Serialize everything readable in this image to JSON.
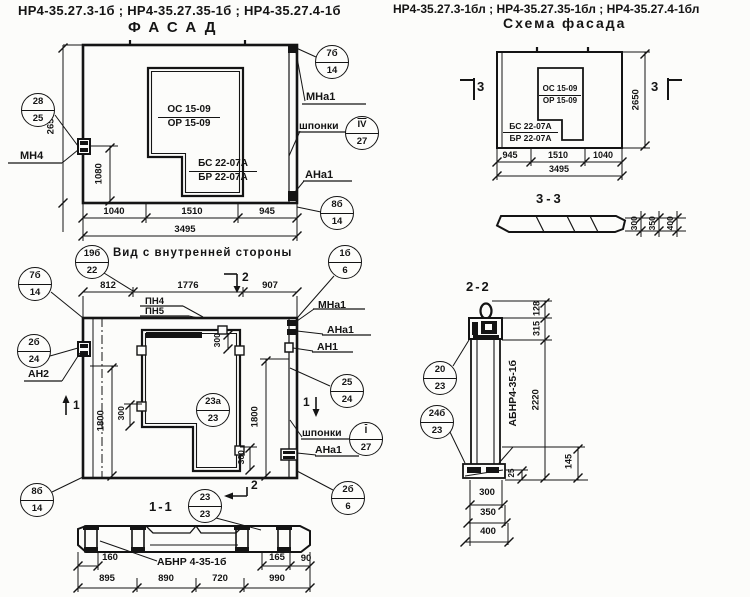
{
  "colors": {
    "ink": "#141414",
    "paper": "#fcfcfa"
  },
  "header": {
    "codes_left": "НР4-35.27.3-1б ;  НР4-35.27.35-1б ;  НР4-35.27.4-1б",
    "codes_right": "НР4-35.27.3-1бл ;  НР4-35.27.35-1бл ;  НР4-35.27.4-1бл"
  },
  "facade": {
    "title": "ФАСАД",
    "opening_mark_top": "ОС 15-09",
    "opening_mark_bottom": "ОР 15-09",
    "sill_mark_top": "БС 22-07А",
    "sill_mark_bottom": "БР 22-07А",
    "dim_height": "2650",
    "dim_inner": "1080",
    "dims_bottom": [
      "1040",
      "1510",
      "945"
    ],
    "dim_total": "3495",
    "label_mn4": "МН4",
    "label_mna1": "МНа1",
    "label_shponki": "шпонки",
    "label_ana1": "АНа1",
    "circle_top_right": {
      "top": "7б",
      "bottom": "14"
    },
    "circle_left": {
      "top": "28",
      "bottom": "25"
    },
    "circle_shponki": {
      "top": "IV",
      "bottom": "27"
    },
    "circle_bottom_right": {
      "top": "8б",
      "bottom": "14"
    }
  },
  "scheme": {
    "title": "Схема фасада",
    "opening_mark_top": "ОС 15-09",
    "opening_mark_bottom": "ОР 15-09",
    "sill_mark_top": "БС 22-07А",
    "sill_mark_bottom": "БР 22-07А",
    "dim_height": "2650",
    "dims_bottom": [
      "945",
      "1510",
      "1040"
    ],
    "dim_total": "3495",
    "section_mark": "3",
    "section_view": {
      "title": "3-3",
      "dims": [
        "300",
        "350",
        "400"
      ]
    }
  },
  "inner_view": {
    "title": "Вид с внутренней стороны",
    "dims_top": [
      "812",
      "1776",
      "907"
    ],
    "label_pn4": "ПН4",
    "label_pn5": "ПН5",
    "dim_left": "1800",
    "dim_right": "1800",
    "dim_300_top": "300",
    "dim_300_left": "300",
    "dim_300_bottom": "300",
    "label_mna1": "МНа1",
    "label_ana1_top": "АНа1",
    "label_an1": "АН1",
    "label_an2": "АН2",
    "label_shponki": "шпонки",
    "label_ana1_bottom": "АНа1",
    "mark_section1": "1",
    "mark_section2": "2",
    "circle_top_left": {
      "top": "19б",
      "bottom": "22"
    },
    "circle_top_right": {
      "top": "1б",
      "bottom": "6"
    },
    "circle_left_upper": {
      "top": "7б",
      "bottom": "14"
    },
    "circle_an2": {
      "top": "2б",
      "bottom": "24"
    },
    "circle_left_lower": {
      "top": "8б",
      "bottom": "14"
    },
    "circle_right_upper": {
      "top": "25",
      "bottom": "24"
    },
    "circle_shponki": {
      "top": "I",
      "bottom": "27"
    },
    "circle_right_lower": {
      "top": "2б",
      "bottom": "6"
    },
    "circle_center": {
      "top": "23а",
      "bottom": "23"
    }
  },
  "section_1_1": {
    "title": "1-1",
    "circle": {
      "top": "23",
      "bottom": "23"
    },
    "panel_mark": "АБНР 4-35-1б",
    "dim_160": "160",
    "dim_165": "165",
    "dim_90": "90",
    "dims_bottom": [
      "895",
      "890",
      "720",
      "990"
    ]
  },
  "section_2_2": {
    "title": "2-2",
    "panel_mark": "АБНР4-35-1б",
    "dim_128": "128",
    "dim_315": "315",
    "dim_2220": "2220",
    "dim_145": "145",
    "dim_25": "25",
    "dims_bottom": [
      "300",
      "350",
      "400"
    ],
    "circle_upper": {
      "top": "20",
      "bottom": "23"
    },
    "circle_lower": {
      "top": "24б",
      "bottom": "23"
    }
  }
}
